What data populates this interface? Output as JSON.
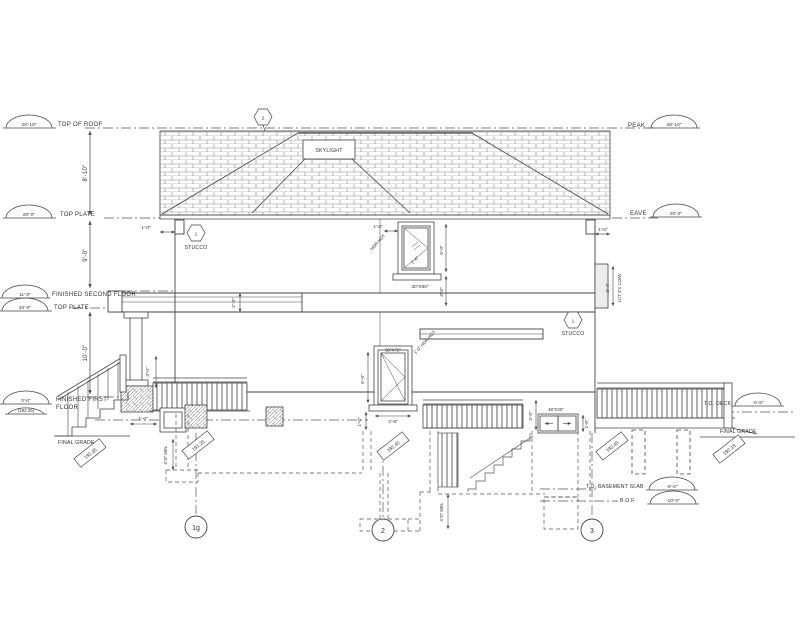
{
  "levels_left": {
    "top_of_roof": {
      "elev": "28'-10\"",
      "label": "TOP OF ROOF"
    },
    "top_plate_upper": {
      "elev": "20'-0\"",
      "label": "TOP PLATE"
    },
    "fin_second_floor": {
      "elev": "11'-0\"",
      "label": "FINISHED SECOND FLOOR"
    },
    "top_plate_lower": {
      "elev": "10'-0\"",
      "label": "TOP PLATE"
    },
    "fin_first_floor": {
      "elev": "0'-0\"",
      "label1": "FINISHED FIRST",
      "label2": "FLOOR",
      "geodetic": "(192.25)"
    },
    "final_grade": {
      "label": "FINAL GRADE",
      "tag": "192.35"
    }
  },
  "levels_right": {
    "peak": {
      "label": "PEAK",
      "elev": "28'-10\""
    },
    "eave": {
      "label": "EAVE",
      "elev": "20'-0\""
    },
    "to_deck": {
      "label": "T.O. DECK",
      "elev": "-0'-8\""
    },
    "final_grade": {
      "label": "FINAL GRADE",
      "tag": "192.18"
    },
    "to_basement_slab": {
      "label": "T.O. BASEMENT SLAB",
      "elev": "-8'-0\""
    },
    "bof": {
      "label": "B.O.F.",
      "elev": "-10'-0\""
    }
  },
  "dims": {
    "roof_storey": "8'-10\"",
    "second_storey": "9'-0\"",
    "first_storey": "10'-0\"",
    "eave_overhang_left": "1'-0\"",
    "eave_overhang_right": "1'-0\"",
    "porch_beam_depth": "2'-0\"",
    "porch_rail_height": "3'-0\"",
    "porch_vent": "1'-0\"",
    "win2_hdr": "1'-0\"",
    "win2_hdr_note": "HDR HGT.",
    "win2_height": "5'-0\"",
    "win2_sill": "3'-0\"",
    "win2_glass": "2'-6\"",
    "win1_height": "6'-0\"",
    "win1_sill": "1'-0\"",
    "win1_width": "2'-6\"",
    "win1_hdr_note": "1'-0\" HDR HGT.",
    "deck_rail_height": "3'-0\"",
    "bsmt_win_height": "1'-8\"",
    "chase_height": "3'-4\"",
    "chase_note": "LCT 3'X CO/W",
    "frost_left": "4'-0\" MIN.",
    "frost_center": "4'-0\" MIN."
  },
  "annotations": {
    "skylight": "SKYLIGHT",
    "stucco_left": "STUCCO",
    "stucco_right": "STUCCO",
    "win2_size": "30\"X60\"",
    "win1_size": "30\"X72\"",
    "bsmt_win_size": "48\"X20\""
  },
  "keynotes": {
    "roof": "2",
    "stucco_left": "1",
    "stucco_right": "1"
  },
  "grade_tags": {
    "left_footing": "191.25",
    "center": "192.40",
    "right": "192.45"
  },
  "grid": {
    "g1": "1g",
    "g2": "2",
    "g3": "3"
  }
}
